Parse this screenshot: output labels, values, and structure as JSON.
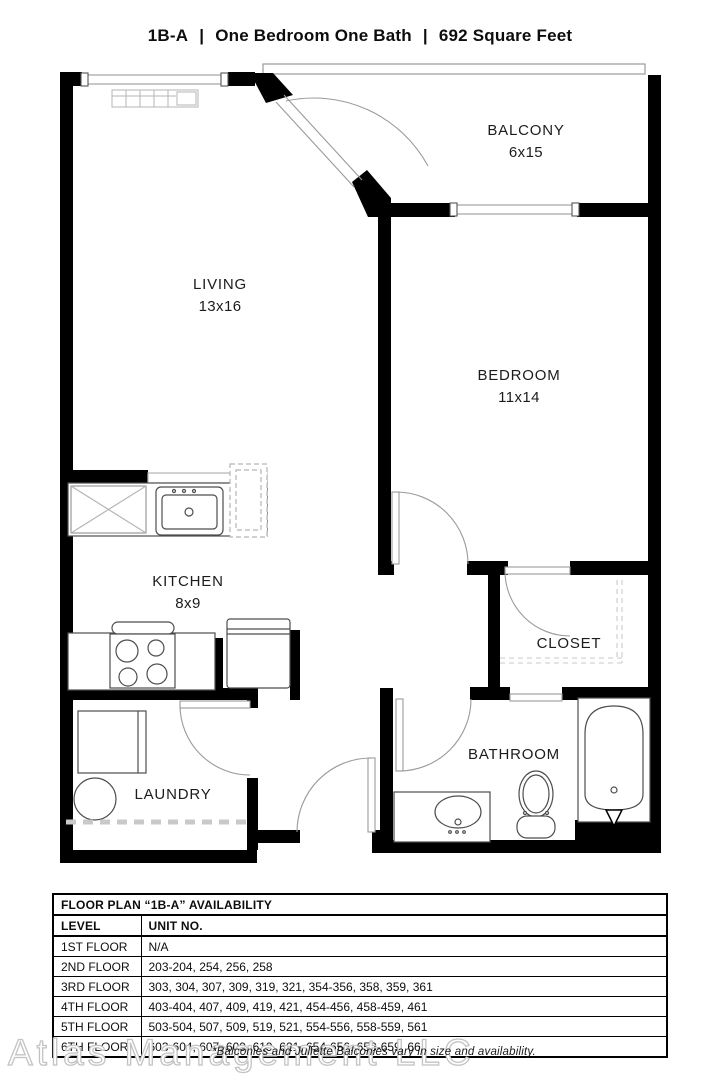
{
  "header": {
    "plan_code": "1B-A",
    "separator": "|",
    "description": "One Bedroom One Bath",
    "area": "692 Square Feet"
  },
  "rooms": {
    "living": {
      "label": "LIVING",
      "dims": "13x16"
    },
    "bedroom": {
      "label": "BEDROOM",
      "dims": "11x14"
    },
    "balcony": {
      "label": "BALCONY",
      "dims": "6x15"
    },
    "kitchen": {
      "label": "KITCHEN",
      "dims": "8x9"
    },
    "laundry": {
      "label": "LAUNDRY"
    },
    "bathroom": {
      "label": "BATHROOM"
    },
    "closet": {
      "label": "CLOSET"
    }
  },
  "availability_table": {
    "title": "FLOOR PLAN “1B-A” AVAILABILITY",
    "columns": [
      "LEVEL",
      "UNIT NO."
    ],
    "rows": [
      [
        "1ST FLOOR",
        "N/A"
      ],
      [
        "2ND FLOOR",
        "203-204, 254, 256, 258"
      ],
      [
        "3RD FLOOR",
        "303, 304, 307, 309, 319, 321, 354-356, 358, 359, 361"
      ],
      [
        "4TH FLOOR",
        "403-404, 407, 409, 419, 421, 454-456, 458-459, 461"
      ],
      [
        "5TH FLOOR",
        "503-504, 507, 509, 519, 521, 554-556, 558-559, 561"
      ],
      [
        "6TH FLOOR",
        "603-604, 607, 609, 619, 621, 654-656, 658-659, 661"
      ]
    ]
  },
  "footer": {
    "watermark": "Atlas Management LLC",
    "note": "*Balconies and Juliette Balconies vary in size and availability."
  },
  "colors": {
    "wall": "#000000",
    "fixture_line": "#4d4d4d",
    "light_line": "#9a9a9a",
    "dashed_line": "#c9c9c9"
  }
}
